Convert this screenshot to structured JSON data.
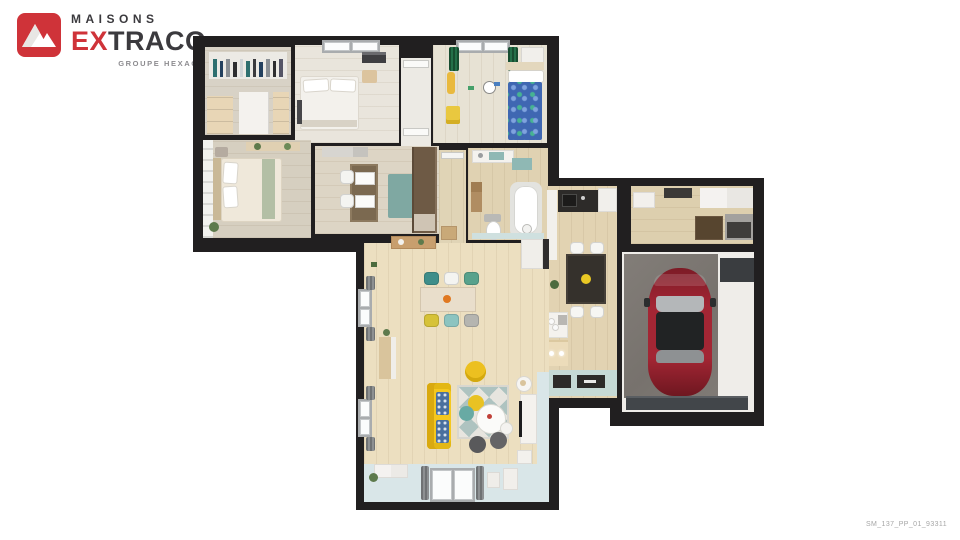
{
  "logo": {
    "brand_line1": "MAISONS",
    "brand_line2_red": "EX",
    "brand_line2_dark": "TRACO",
    "subtitle": "GROUPE HEXAŌM",
    "colors": {
      "red": "#cf3339",
      "dark": "#3b3a3e",
      "gray": "#8d8c90"
    }
  },
  "plan": {
    "reference_code": "SM_137_PP_01_93311",
    "render_style": "3D top-down house floor plan render",
    "rooms": [
      {
        "name": "dressing",
        "furniture": [
          "hanging-clothes",
          "drawer-units"
        ]
      },
      {
        "name": "bedroom-1",
        "furniture": [
          "double-bed",
          "nightstand",
          "window"
        ]
      },
      {
        "name": "kids-bedroom",
        "furniture": [
          "blue-single-bed",
          "green-curtains",
          "giraffe-toy",
          "wall-clock",
          "toy-box"
        ]
      },
      {
        "name": "master-bedroom",
        "furniture": [
          "double-bed",
          "white-brick-wall",
          "wall-shelf",
          "plant"
        ]
      },
      {
        "name": "office-bedroom",
        "furniture": [
          "desk",
          "two-white-chairs",
          "teal-rug",
          "wardrobe"
        ]
      },
      {
        "name": "bathroom",
        "furniture": [
          "bathtub",
          "toilet",
          "vanity",
          "cabinet"
        ]
      },
      {
        "name": "hallway",
        "furniture": [
          "console"
        ]
      },
      {
        "name": "kitchen",
        "furniture": [
          "sink-counter",
          "dining-table-4-chairs",
          "island-bar",
          "hob-counter",
          "fridge"
        ]
      },
      {
        "name": "utility-room",
        "furniture": [
          "washing-machine",
          "cabinets"
        ]
      },
      {
        "name": "garage",
        "furniture": [
          "red-car",
          "garage-door"
        ]
      },
      {
        "name": "living-dining-room",
        "furniture": [
          "yellow-sofa",
          "diamond-rug",
          "round-coffee-table",
          "dining-table-6-chairs",
          "tv-console",
          "bay-window",
          "yellow-pouf"
        ]
      }
    ],
    "palette": {
      "walls": "#211f20",
      "wood_floor": "#e9dcbd",
      "tile_floor": "#d9e6e8",
      "concrete": "#7d7873",
      "car_red": "#9c2531",
      "sofa_yellow": "#f2c51d",
      "accent_teal": "#6fa8a4",
      "curtain_green": "#1f5c3a",
      "kid_bed_blue": "#3f67b2"
    }
  }
}
